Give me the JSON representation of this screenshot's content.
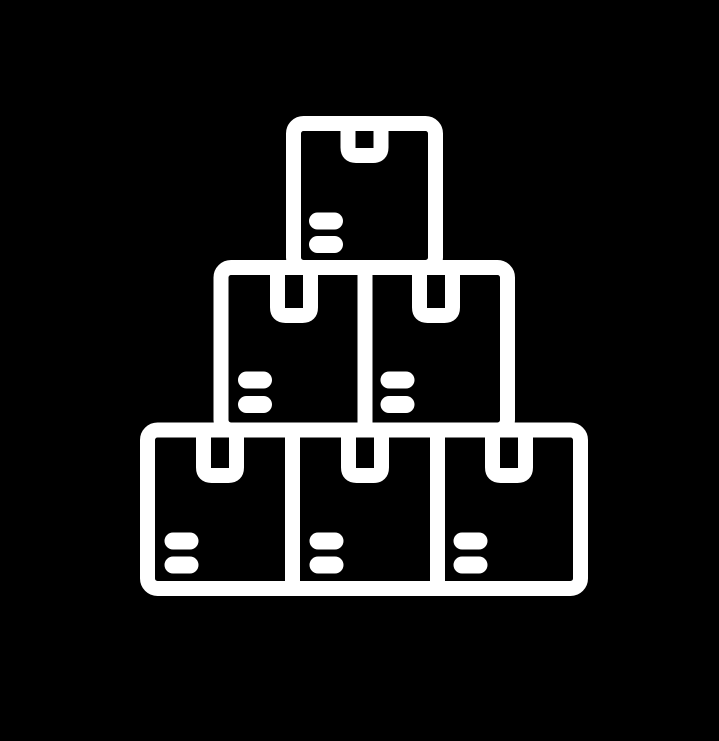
{
  "page": {
    "background_color": "#000000"
  },
  "icon": {
    "name": "stacked-boxes-icon",
    "aria_label": "Stack of cardboard boxes",
    "color": "#ffffff",
    "background_color": "#000000",
    "stroke_width_px": 15,
    "total_boxes": 6,
    "rows": [
      {
        "position": "top",
        "box_count": 1
      },
      {
        "position": "middle",
        "box_count": 2
      },
      {
        "position": "bottom",
        "box_count": 3
      }
    ],
    "box_features": {
      "tape_slot": "rectangular notch hanging from top edge center of each box",
      "label_lines_per_box": 2
    }
  }
}
